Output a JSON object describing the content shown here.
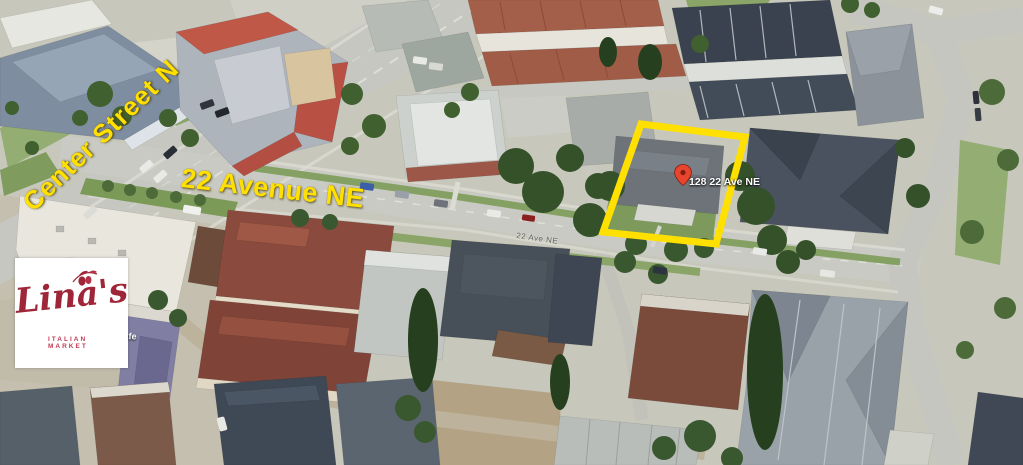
{
  "annotations": {
    "center_street_label": "Center Street N",
    "avenue_label": "22 Avenue NE",
    "property_address_label": "128 22 Ave NE",
    "road_small_label": "22 Ave NE",
    "cafe_label": "Cafe",
    "highlight_box_color": "#FFE000",
    "street_label_color": "#FFE000",
    "address_label_color": "#FFFFFF",
    "pin_icon": "location-pin",
    "pin_color": "#E8452C"
  },
  "logo": {
    "name": "Lina's",
    "tagline": "ITALIAN MARKET",
    "brand_color": "#9E2638",
    "background_color": "#FFFFFF",
    "icon": "olive-branch"
  }
}
